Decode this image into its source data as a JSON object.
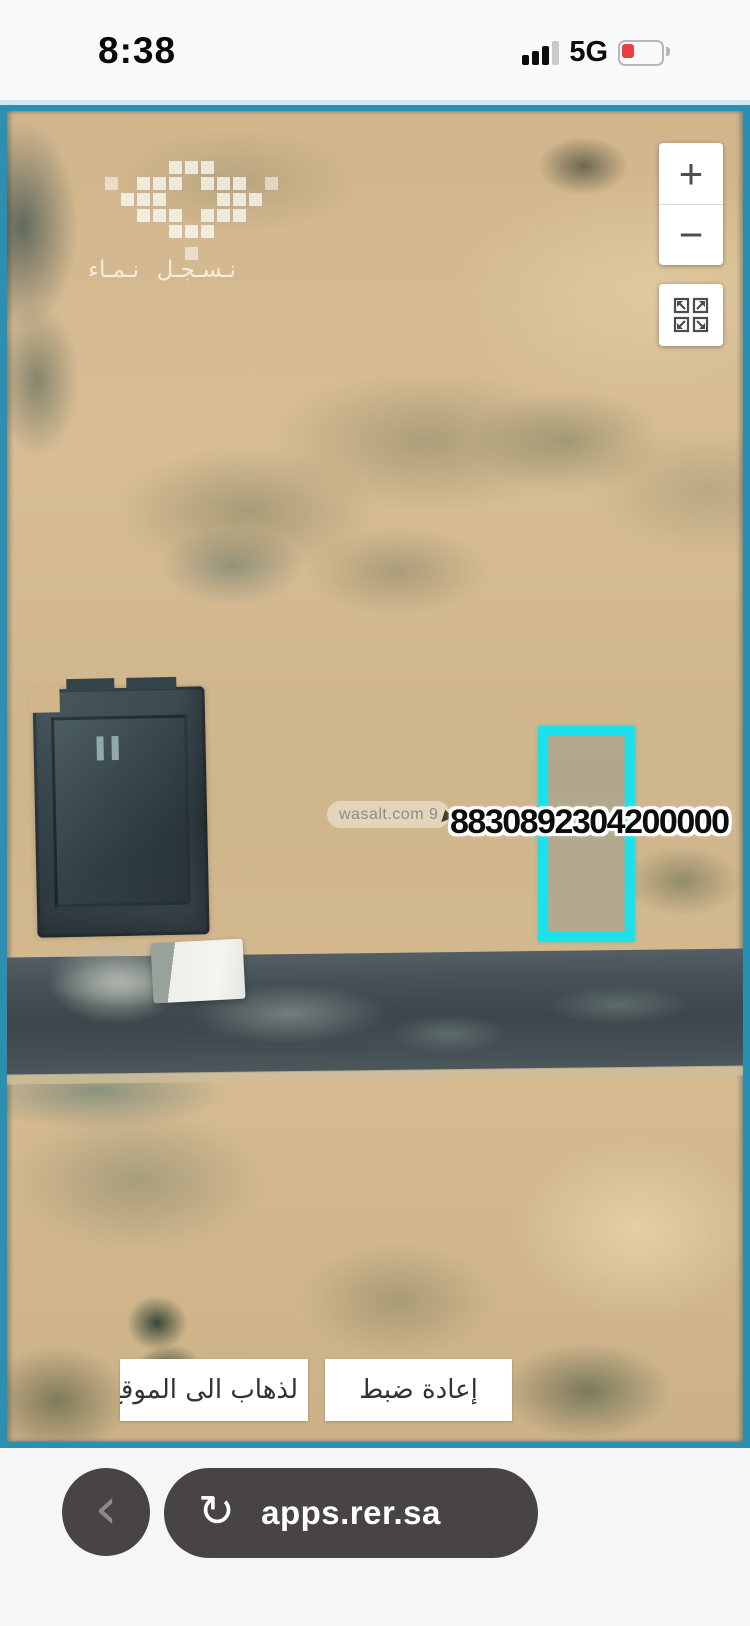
{
  "status_bar": {
    "time": "8:38",
    "network": "5G"
  },
  "map": {
    "provider_watermark": {
      "slogan": "نـسـجـل نـمـاء"
    },
    "wasalt_watermark": "wasalt.com 9",
    "parcel": {
      "number": "8830892304200000",
      "outline_color": "#1ce1ea"
    },
    "zoom_control": {
      "zoom_in": "+",
      "zoom_out": "−"
    },
    "action_buttons": {
      "go_to_location": "لذهاب الى الموقع",
      "reset": "إعادة ضبط"
    }
  },
  "browser_bar": {
    "url": "apps.rer.sa",
    "reload_icon": "↻",
    "back_icon": "‹"
  },
  "colors": {
    "map_border": "#2a8fb0",
    "parcel_outline": "#1ce1ea",
    "battery_low": "#ec3d43",
    "browser_pill": "#484445",
    "sand_base": "#d1b58c"
  }
}
